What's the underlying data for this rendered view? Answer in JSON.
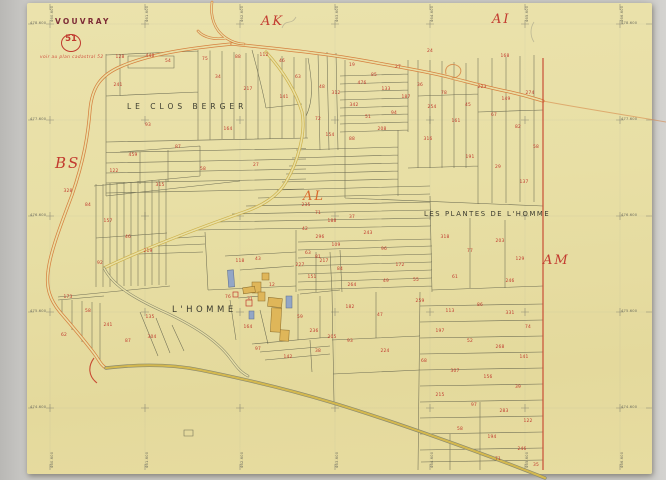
{
  "map": {
    "commune": "VOUVRAY",
    "sheet_number": "51",
    "note": "voir au plan cadastral 52",
    "sections": [
      {
        "label": "AK",
        "x": 261,
        "y": 15,
        "color": "#c23b30",
        "big": false
      },
      {
        "label": "AI",
        "x": 492,
        "y": 13,
        "color": "#c23b30",
        "big": false
      },
      {
        "label": "BS",
        "x": 55,
        "y": 156,
        "color": "#c23b30",
        "big": true
      },
      {
        "label": "AL",
        "x": 303,
        "y": 190,
        "color": "#d8682c",
        "big": false
      },
      {
        "label": "AM",
        "x": 543,
        "y": 254,
        "color": "#c23b30",
        "big": false
      }
    ],
    "placenames": [
      {
        "label": "LE CLOS BERGER",
        "x": 127,
        "y": 103,
        "size": 7.5,
        "ls": 4
      },
      {
        "label": "LES PLANTES DE L'HOMME",
        "x": 424,
        "y": 211,
        "size": 6.8,
        "ls": 1.6
      },
      {
        "label": "L'HOMME",
        "x": 172,
        "y": 306,
        "size": 8.5,
        "ls": 3.5
      }
    ],
    "margin": {
      "left": [
        {
          "t": "478.600",
          "y": 24
        },
        {
          "t": "477.600",
          "y": 120
        },
        {
          "t": "476.600",
          "y": 216
        },
        {
          "t": "475.600",
          "y": 312
        },
        {
          "t": "474.600",
          "y": 408
        }
      ],
      "right": [
        {
          "t": "478.600",
          "y": 24
        },
        {
          "t": "477.600",
          "y": 120
        },
        {
          "t": "476.600",
          "y": 216
        },
        {
          "t": "475.600",
          "y": 312
        },
        {
          "t": "474.600",
          "y": 408
        }
      ],
      "top": [
        {
          "t": "460.600",
          "x": 50
        },
        {
          "t": "461.600",
          "x": 145
        },
        {
          "t": "462.600",
          "x": 240
        },
        {
          "t": "463.600",
          "x": 335
        },
        {
          "t": "464.600",
          "x": 430
        },
        {
          "t": "465.600",
          "x": 525
        },
        {
          "t": "466.600",
          "x": 620
        }
      ],
      "bottom": [
        {
          "t": "460.600",
          "x": 50
        },
        {
          "t": "461.600",
          "x": 145
        },
        {
          "t": "462.600",
          "x": 240
        },
        {
          "t": "463.600",
          "x": 335
        },
        {
          "t": "464.600",
          "x": 430
        },
        {
          "t": "465.600",
          "x": 525
        },
        {
          "t": "466.600",
          "x": 620
        }
      ]
    },
    "grid": {
      "xs": [
        50,
        145,
        240,
        335,
        430,
        525,
        620
      ],
      "ys": [
        24,
        120,
        216,
        312,
        408
      ]
    },
    "colors": {
      "paper": "#e8dfa5",
      "road_orange": "#d6803f",
      "road_yellow": "#d0b44a",
      "parcel_ink": "#62624c",
      "number_red": "#c0392e",
      "building_yellow": "#dfb659",
      "building_blue": "#93a6c6",
      "boundary_red": "#c84a33"
    },
    "parcel_numbers": [
      [
        120,
        58,
        "128"
      ],
      [
        150,
        57,
        "448"
      ],
      [
        168,
        62,
        "54"
      ],
      [
        205,
        60,
        "75"
      ],
      [
        238,
        58,
        "88"
      ],
      [
        264,
        56,
        "112"
      ],
      [
        282,
        62,
        "46"
      ],
      [
        118,
        86,
        "241"
      ],
      [
        148,
        126,
        "93"
      ],
      [
        133,
        156,
        "459"
      ],
      [
        114,
        172,
        "122"
      ],
      [
        178,
        148,
        "87"
      ],
      [
        228,
        130,
        "164"
      ],
      [
        203,
        170,
        "58"
      ],
      [
        218,
        78,
        "34"
      ],
      [
        248,
        90,
        "217"
      ],
      [
        284,
        98,
        "141"
      ],
      [
        298,
        78,
        "63"
      ],
      [
        256,
        166,
        "27"
      ],
      [
        160,
        186,
        "315"
      ],
      [
        352,
        66,
        "19"
      ],
      [
        362,
        84,
        "476"
      ],
      [
        374,
        76,
        "85"
      ],
      [
        386,
        90,
        "133"
      ],
      [
        398,
        68,
        "27"
      ],
      [
        354,
        106,
        "342"
      ],
      [
        368,
        118,
        "51"
      ],
      [
        382,
        130,
        "208"
      ],
      [
        394,
        114,
        "94"
      ],
      [
        406,
        98,
        "187"
      ],
      [
        420,
        86,
        "36"
      ],
      [
        432,
        108,
        "254"
      ],
      [
        444,
        94,
        "78"
      ],
      [
        456,
        122,
        "161"
      ],
      [
        468,
        106,
        "45"
      ],
      [
        482,
        88,
        "223"
      ],
      [
        494,
        116,
        "67"
      ],
      [
        506,
        100,
        "149"
      ],
      [
        518,
        128,
        "82"
      ],
      [
        530,
        94,
        "274"
      ],
      [
        536,
        148,
        "58"
      ],
      [
        470,
        158,
        "191"
      ],
      [
        498,
        168,
        "29"
      ],
      [
        524,
        183,
        "137"
      ],
      [
        430,
        52,
        "24"
      ],
      [
        505,
        57,
        "168"
      ],
      [
        352,
        140,
        "88"
      ],
      [
        428,
        140,
        "316"
      ],
      [
        322,
        88,
        "48"
      ],
      [
        336,
        94,
        "312"
      ],
      [
        318,
        120,
        "72"
      ],
      [
        330,
        136,
        "154"
      ],
      [
        306,
        206,
        "235"
      ],
      [
        318,
        214,
        "71"
      ],
      [
        332,
        222,
        "188"
      ],
      [
        305,
        230,
        "42"
      ],
      [
        320,
        238,
        "296"
      ],
      [
        336,
        246,
        "109"
      ],
      [
        308,
        254,
        "63"
      ],
      [
        324,
        262,
        "217"
      ],
      [
        340,
        270,
        "84"
      ],
      [
        312,
        278,
        "151"
      ],
      [
        352,
        218,
        "37"
      ],
      [
        368,
        234,
        "243"
      ],
      [
        384,
        250,
        "96"
      ],
      [
        400,
        266,
        "172"
      ],
      [
        416,
        281,
        "55"
      ],
      [
        352,
        286,
        "264"
      ],
      [
        386,
        282,
        "49"
      ],
      [
        445,
        238,
        "318"
      ],
      [
        470,
        252,
        "77"
      ],
      [
        500,
        242,
        "203"
      ],
      [
        520,
        260,
        "129"
      ],
      [
        455,
        278,
        "61"
      ],
      [
        510,
        282,
        "246"
      ],
      [
        350,
        308,
        "182"
      ],
      [
        380,
        316,
        "47"
      ],
      [
        420,
        302,
        "259"
      ],
      [
        450,
        312,
        "113"
      ],
      [
        480,
        306,
        "86"
      ],
      [
        510,
        314,
        "331"
      ],
      [
        528,
        328,
        "74"
      ],
      [
        440,
        332,
        "197"
      ],
      [
        470,
        342,
        "52"
      ],
      [
        500,
        348,
        "268"
      ],
      [
        524,
        358,
        "141"
      ],
      [
        350,
        342,
        "93"
      ],
      [
        385,
        352,
        "224"
      ],
      [
        424,
        362,
        "68"
      ],
      [
        455,
        372,
        "307"
      ],
      [
        488,
        378,
        "156"
      ],
      [
        518,
        388,
        "39"
      ],
      [
        440,
        396,
        "215"
      ],
      [
        474,
        406,
        "97"
      ],
      [
        504,
        412,
        "283"
      ],
      [
        528,
        422,
        "122"
      ],
      [
        460,
        430,
        "58"
      ],
      [
        492,
        438,
        "194"
      ],
      [
        522,
        450,
        "246"
      ],
      [
        498,
        460,
        "71"
      ],
      [
        536,
        466,
        "35"
      ],
      [
        68,
        192,
        "328"
      ],
      [
        88,
        206,
        "84"
      ],
      [
        108,
        222,
        "157"
      ],
      [
        128,
        238,
        "46"
      ],
      [
        148,
        252,
        "219"
      ],
      [
        100,
        264,
        "92"
      ],
      [
        68,
        298,
        "173"
      ],
      [
        88,
        312,
        "58"
      ],
      [
        108,
        326,
        "241"
      ],
      [
        128,
        342,
        "87"
      ],
      [
        150,
        318,
        "135"
      ],
      [
        64,
        336,
        "62"
      ],
      [
        152,
        338,
        "304"
      ],
      [
        240,
        262,
        "118"
      ],
      [
        258,
        260,
        "43"
      ],
      [
        300,
        266,
        "227"
      ],
      [
        318,
        258,
        "81"
      ],
      [
        248,
        328,
        "164"
      ],
      [
        300,
        318,
        "59"
      ],
      [
        314,
        332,
        "236"
      ],
      [
        258,
        350,
        "97"
      ],
      [
        288,
        358,
        "142"
      ],
      [
        318,
        352,
        "38"
      ],
      [
        332,
        338,
        "205"
      ],
      [
        228,
        298,
        "76"
      ],
      [
        250,
        300,
        "31"
      ],
      [
        272,
        286,
        "12"
      ]
    ]
  }
}
